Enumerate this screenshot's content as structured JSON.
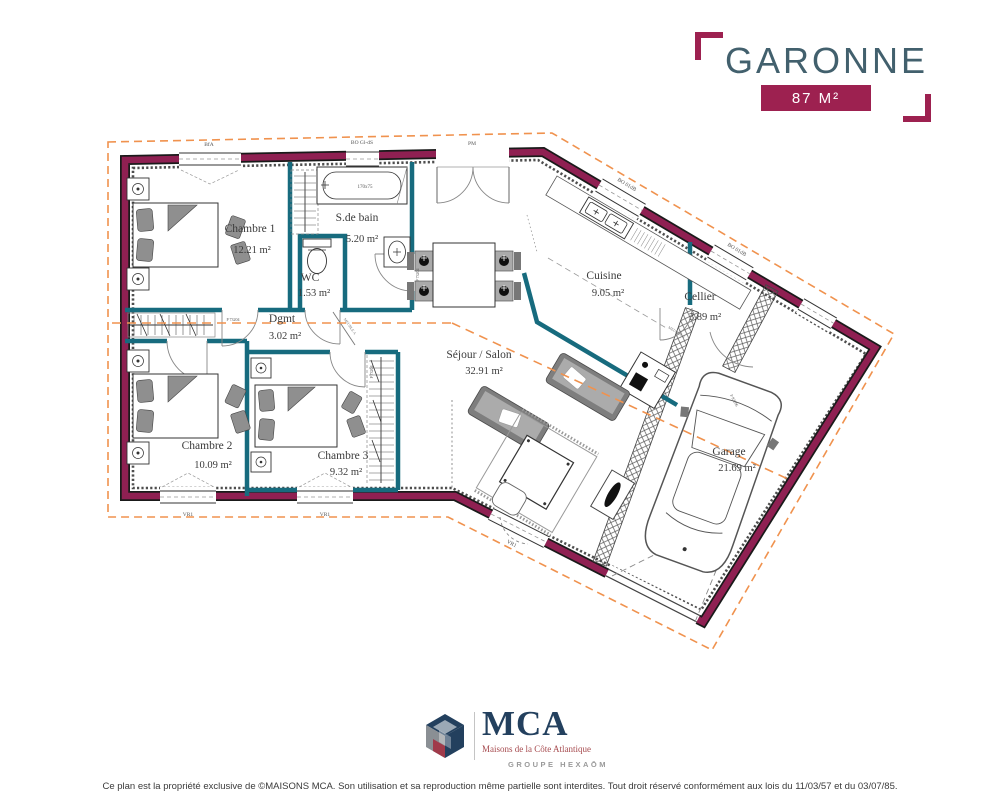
{
  "title_block": {
    "name": "GARONNE",
    "area_badge": "87 M²"
  },
  "rooms": {
    "chambre1": {
      "label": "Chambre 1",
      "area": "12.21 m²"
    },
    "sdb": {
      "label": "S.de bain",
      "area": "5.20 m²"
    },
    "wc": {
      "label": "WC",
      "area": "1.53 m²"
    },
    "dgmt": {
      "label": "Dgmt",
      "area": "3.02 m²"
    },
    "chambre2": {
      "label": "Chambre 2",
      "area": "10.09 m²"
    },
    "chambre3": {
      "label": "Chambre 3",
      "area": "9.32 m²"
    },
    "sejour": {
      "label": "Séjour / Salon",
      "area": "32.91 m²"
    },
    "cuisine": {
      "label": "Cuisine",
      "area": "9.05 m²"
    },
    "cellier": {
      "label": "Cellier",
      "area": "3.89 m²"
    },
    "garage": {
      "label": "Garage",
      "area": "21.69 m²"
    }
  },
  "annotations": {
    "bathtub_size": "170x75",
    "window_code_top_left": "BfA",
    "window_code_bath": "BO Gl-dS",
    "door_code_entrance": "PM",
    "window_code_angled": "BO 01dB",
    "window_code_roller": "VR1",
    "door_code_interior": "P 73204",
    "door_code_cellier": "P 93206",
    "furniture_code": "MEUBLE A"
  },
  "logo": {
    "brand": "MCA",
    "tagline": "Maisons de la Côte Atlantique",
    "group": "GROUPE HEXAŌM"
  },
  "footer": {
    "disclaimer": "Ce plan est la propriété exclusive de ©MAISONS MCA. Son utilisation et sa reproduction même partielle sont interdites. Tout droit réservé conformément aux lois du 11/03/57 et du 03/07/85."
  },
  "colors": {
    "wall": "#8F2052",
    "accent": "#9D2150",
    "interior_wall": "#176B7E",
    "roof_dashed": "#F0924E",
    "title": "#42606D",
    "logo_navy": "#23405E",
    "logo_red": "#A64A4E",
    "logo_gray": "#9A9A9A"
  }
}
